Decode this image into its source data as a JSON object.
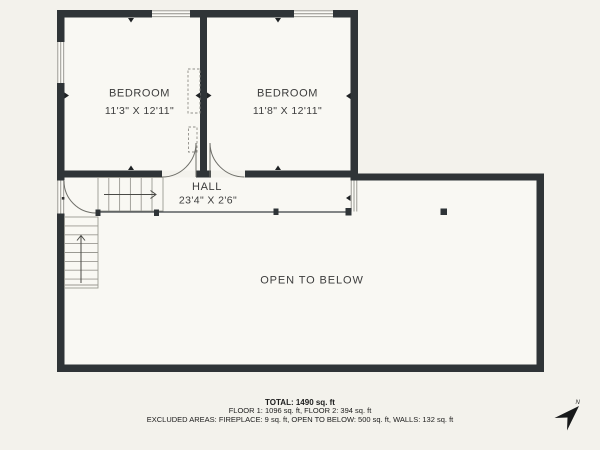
{
  "colors": {
    "background": "#f3f2ec",
    "room_fill": "#f9f8f3",
    "wall": "#2f3437",
    "text": "#3c3c3c"
  },
  "rooms": {
    "bedroom1": {
      "name": "BEDROOM",
      "dims": "11'3\" X 12'11\""
    },
    "bedroom2": {
      "name": "BEDROOM",
      "dims": "11'8\" X 12'11\""
    },
    "hall": {
      "name": "HALL",
      "dims": "23'4\" X 2'6\""
    },
    "open": {
      "name": "OPEN TO BELOW"
    }
  },
  "summary": {
    "total": "TOTAL: 1490 sq. ft",
    "floors": "FLOOR 1: 1096 sq. ft, FLOOR 2: 394 sq. ft",
    "excluded": "EXCLUDED AREAS: FIREPLACE: 9 sq. ft, OPEN TO BELOW: 500 sq. ft, WALLS: 132 sq. ft"
  },
  "compass": {
    "label": "N"
  }
}
